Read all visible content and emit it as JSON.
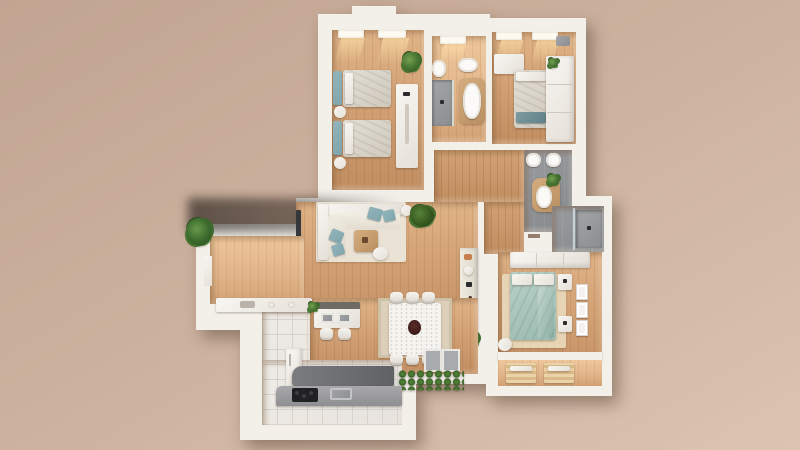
{
  "meta": {
    "title": "3D top-down apartment floor plan render",
    "view": "bird's-eye 3D architectural rendering",
    "canvas": {
      "width": 800,
      "height": 450
    }
  },
  "palette": {
    "ground": "#ccb19e",
    "ground-dark": "#c1a592",
    "ground-light": "#dbc4b1",
    "wall": "#f3f0ea",
    "wood": "#d2a175",
    "wood-light": "#e0b488",
    "wood-dark": "#c08d60",
    "wood-furn": "#b98f60",
    "tile": "#e6e3de",
    "tile-line": "#d6d1ca",
    "bath-gray": "#9b9da0",
    "bath-gray-dark": "#84878a",
    "teal": "#7fa6ad",
    "sage": "#9cbcb2",
    "bedding": "#cfc9bd",
    "plant": "#44722f",
    "plant-dark": "#2f5420",
    "counter-gray": "#9b9b9d",
    "counter-dark": "#6e6f72",
    "cooktop": "#212124",
    "glow": "#ffe2a8"
  },
  "scene": {
    "rooms": [
      {
        "name": "bedroom-twin",
        "position": "top-left",
        "furniture": [
          "single-bed",
          "single-bed",
          "teal-headboards",
          "round-nightstand",
          "round-nightstand",
          "console-desk",
          "potted-plant",
          "two-windows"
        ]
      },
      {
        "name": "bathroom-main",
        "position": "top-center",
        "furniture": [
          "toilet",
          "bidet",
          "freestanding-bathtub",
          "walk-in-shower",
          "window"
        ]
      },
      {
        "name": "bedroom-single",
        "position": "top-right",
        "furniture": [
          "single-bed",
          "desk",
          "wardrobe",
          "plant-on-wardrobe",
          "two-windows"
        ]
      },
      {
        "name": "hallway",
        "position": "center",
        "furniture": []
      },
      {
        "name": "bathroom-guest",
        "position": "center-right",
        "furniture": [
          "toilet",
          "toilet",
          "wood-vanity-with-sink",
          "plant"
        ]
      },
      {
        "name": "shower-room",
        "position": "right-annex",
        "furniture": [
          "glass-shower"
        ]
      },
      {
        "name": "bedroom-master",
        "position": "bottom-right",
        "furniture": [
          "double-bed-sage",
          "white-pillows",
          "nightstand",
          "nightstand",
          "wardrobe",
          "beige-rug",
          "three-wall-frames",
          "armchair",
          "balcony-lounger",
          "balcony-lounger"
        ]
      },
      {
        "name": "living-room",
        "position": "center-left",
        "furniture": [
          "l-shaped-cream-sofa",
          "teal-cushions",
          "cream-rug",
          "round-coffee-table",
          "small-round-table",
          "pouf",
          "wall-tv",
          "floor-plant",
          "shelf-unit",
          "guitar",
          "shelf-plant"
        ]
      },
      {
        "name": "dining-area",
        "position": "bottom-center",
        "furniture": [
          "marble-table",
          "dark-centerpiece",
          "chair",
          "chair",
          "chair",
          "chair",
          "chair",
          "chair",
          "beige-rug",
          "doormat",
          "doormat"
        ]
      },
      {
        "name": "kitchen",
        "position": "bottom-left",
        "furniture": [
          "island-with-two-sinks",
          "island-plant",
          "bar-stool",
          "bar-stool",
          "top-counter-with-board",
          "fridge-column",
          "dark-bar-counter",
          "base-counter",
          "black-cooktop",
          "steel-sink"
        ]
      }
    ],
    "exterior": [
      "corner-potted-plant",
      "hedge-planter",
      "overhang-shadow",
      "tan-ground"
    ]
  }
}
